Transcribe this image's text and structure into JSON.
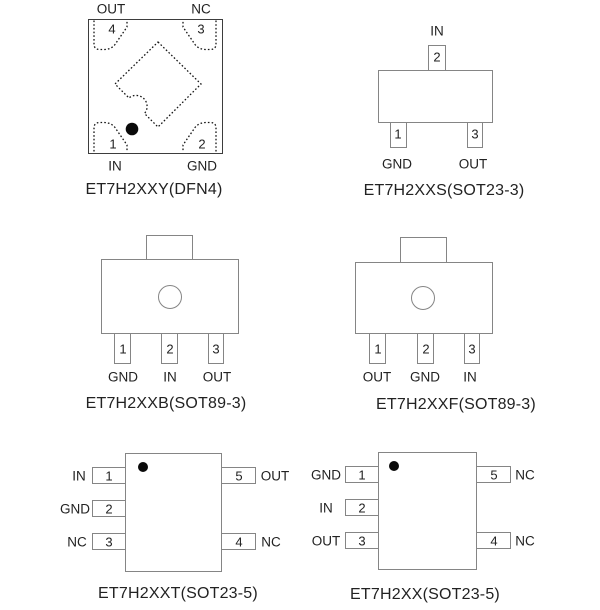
{
  "colors": {
    "outline_gray": "#858585",
    "dfn_outline": "#3d3d3d",
    "dotted_pad": "#161616",
    "pin1_marker": "#0a0a0a",
    "text": "#222222",
    "background": "#ffffff"
  },
  "dfn4": {
    "caption": "ET7H2XXY(DFN4)",
    "pads": {
      "top_left": {
        "num": "4",
        "label": "OUT"
      },
      "top_right": {
        "num": "3",
        "label": "NC"
      },
      "bottom_left": {
        "num": "1",
        "label": "IN"
      },
      "bottom_right": {
        "num": "2",
        "label": "GND"
      }
    }
  },
  "sot23_3": {
    "caption": "ET7H2XXS(SOT23-3)",
    "top_pin": {
      "num": "2",
      "label": "IN"
    },
    "bottom_left_pin": {
      "num": "1",
      "label": "GND"
    },
    "bottom_right_pin": {
      "num": "3",
      "label": "OUT"
    }
  },
  "sot89_b": {
    "caption": "ET7H2XXB(SOT89-3)",
    "pins": [
      {
        "num": "1",
        "label": "GND"
      },
      {
        "num": "2",
        "label": "IN"
      },
      {
        "num": "3",
        "label": "OUT"
      }
    ]
  },
  "sot89_f": {
    "caption": "ET7H2XXF(SOT89-3)",
    "pins": [
      {
        "num": "1",
        "label": "OUT"
      },
      {
        "num": "2",
        "label": "GND"
      },
      {
        "num": "3",
        "label": "IN"
      }
    ]
  },
  "sot23_5_t": {
    "caption": "ET7H2XXT(SOT23-5)",
    "left_pins": [
      {
        "num": "1",
        "label": "IN"
      },
      {
        "num": "2",
        "label": "GND"
      },
      {
        "num": "3",
        "label": "NC"
      }
    ],
    "right_pins": [
      {
        "num": "5",
        "label": "OUT"
      },
      {
        "num": "4",
        "label": "NC"
      }
    ]
  },
  "sot23_5_x": {
    "caption": "ET7H2XX(SOT23-5)",
    "left_pins": [
      {
        "num": "1",
        "label": "GND"
      },
      {
        "num": "2",
        "label": "IN"
      },
      {
        "num": "3",
        "label": "OUT"
      }
    ],
    "right_pins": [
      {
        "num": "5",
        "label": "NC"
      },
      {
        "num": "4",
        "label": "NC"
      }
    ]
  }
}
